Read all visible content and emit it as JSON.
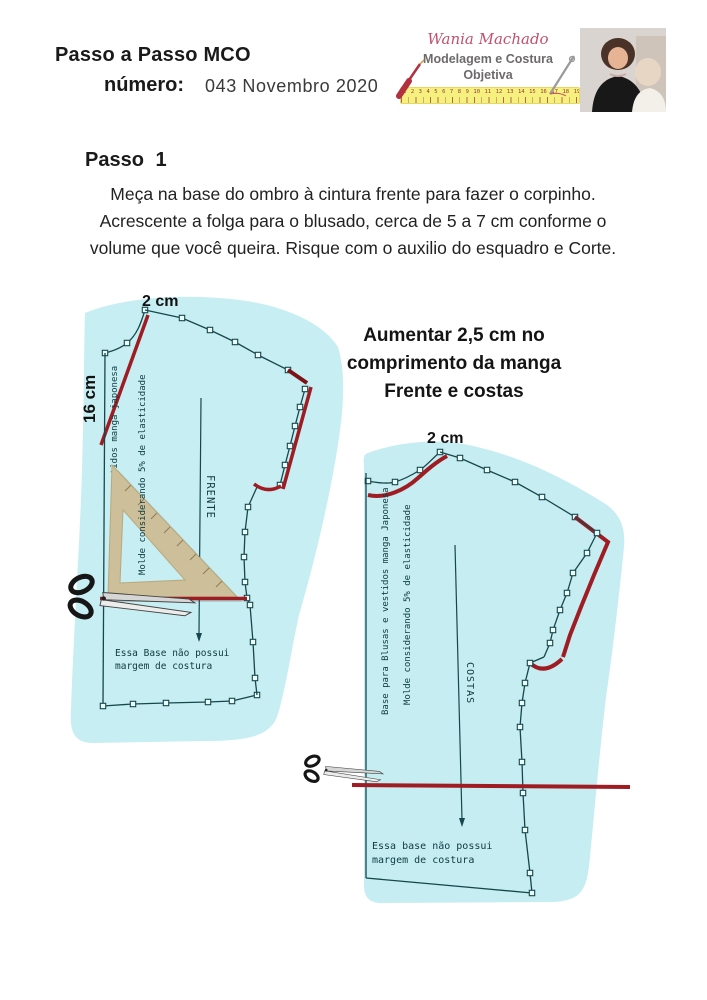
{
  "header": {
    "title": "Passo a Passo MCO",
    "number_label": "número:",
    "number_value": "043 Novembro 2020"
  },
  "logo": {
    "name": "Wania Machado",
    "tagline1": "Modelagem e Costura",
    "tagline2": "Objetiva",
    "ruler_numbers": "1 2 3 4 5 6 7 8 9 10 11 12 13 14 15 16 17 18 19 20 21 22 23 24"
  },
  "step": {
    "heading": "Passo 1",
    "line1": "Meça na base do ombro à cintura frente para fazer o corpinho.",
    "line2": "Acrescente a folga para o blusado, cerca de 5 a 7 cm conforme o",
    "line3": "volume que você queira. Risque com o auxilio do esquadro e Corte."
  },
  "annotation": {
    "line1": "Aumentar 2,5 cm no",
    "line2": "comprimento da manga",
    "line3": "Frente e costas"
  },
  "front_pattern": {
    "label_top": "2 cm",
    "label_side": "16 cm",
    "edge_text": "estidos manga japonesa",
    "mold_text": "Molde considerando 5% de elasticidade",
    "piece_label": "FRENTE",
    "note_line1": "Essa Base não possui",
    "note_line2": "margem de costura"
  },
  "back_pattern": {
    "label_top": "2 cm",
    "edge_text": "Base para Blusas e vestidos manga Japonesa",
    "mold_text": "Molde considerando 5% de elasticidade",
    "piece_label": "COSTAS",
    "note_line1": "Essa base não possui",
    "note_line2": "margem de costura"
  },
  "colors": {
    "pattern_fill": "#c7eef2",
    "outline": "#16474c",
    "red": "#9e1c22",
    "ruler_tan": "#cdbf99",
    "logo_pink": "#c2516b",
    "logo_gray": "#6d6a6a",
    "ruler_yellow": "#f6f07e"
  }
}
